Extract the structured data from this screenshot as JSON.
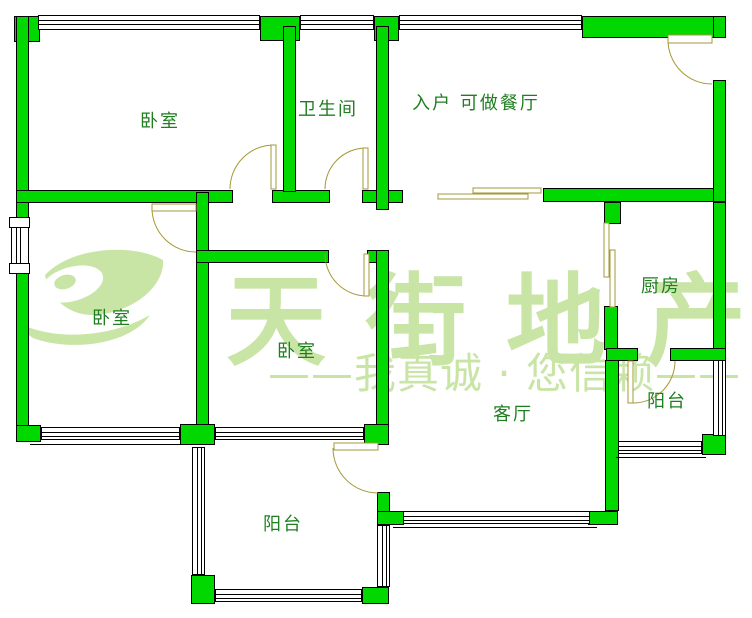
{
  "page": {
    "type": "real-estate floor plan drawing"
  },
  "colors": {
    "wall_fill": "#00d800",
    "wall_outline": "#000000",
    "door": "#a59838",
    "room_label": "#1f7e1f",
    "watermark": "#c8e5a6",
    "background": "#ffffff"
  },
  "rooms": [
    {
      "id": "bedroom-top-left",
      "label": "卧室"
    },
    {
      "id": "bathroom",
      "label": "卫生间"
    },
    {
      "id": "entry-dining",
      "label": "入户 可做餐厅"
    },
    {
      "id": "bedroom-mid-left",
      "label": "卧室"
    },
    {
      "id": "bedroom-center",
      "label": "卧室"
    },
    {
      "id": "kitchen",
      "label": "厨房"
    },
    {
      "id": "living-room",
      "label": "客厅"
    },
    {
      "id": "balcony-bottom",
      "label": "阳台"
    },
    {
      "id": "balcony-right",
      "label": "阳台"
    }
  ],
  "watermark": {
    "brand": "天街地产",
    "slogan": "——我真诚 · 您信赖——"
  }
}
